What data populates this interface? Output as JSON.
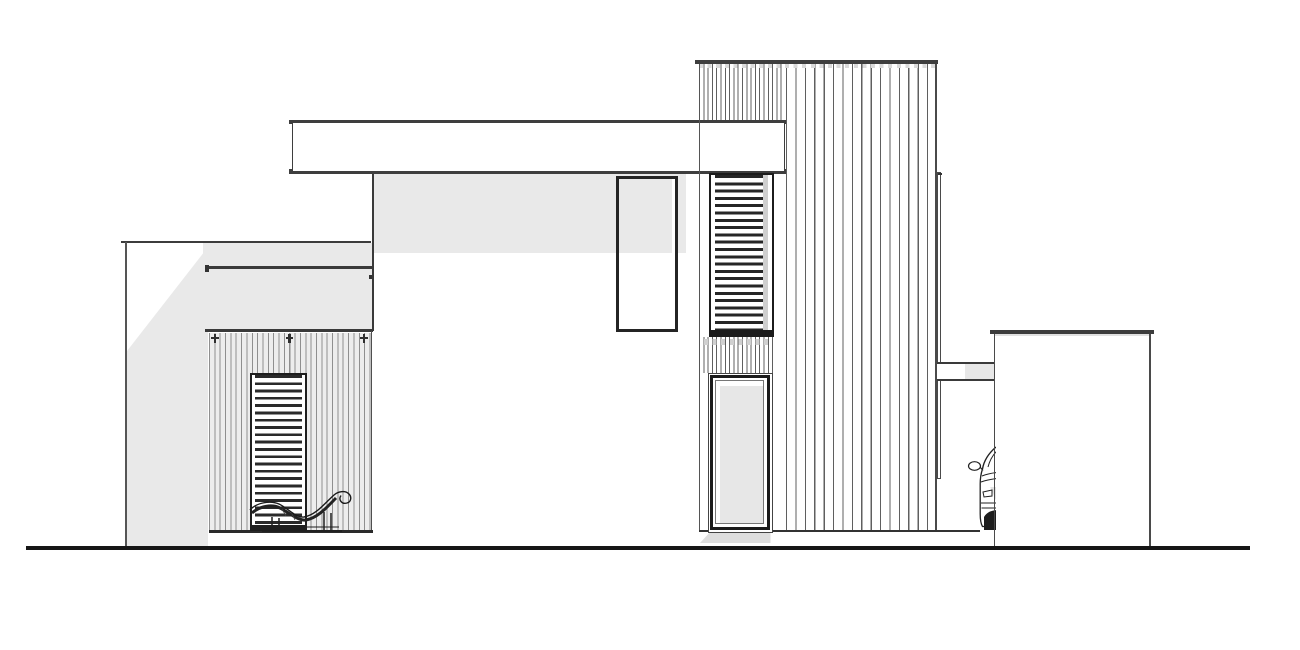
{
  "drawing": {
    "kind": "architectural-side-elevation",
    "canvas": {
      "w": 1300,
      "h": 650,
      "background": "#ffffff"
    },
    "palette": {
      "paper": "#ffffff",
      "line_dark": "#1c1c1c",
      "line_mid": "#3e3e3e",
      "line_light": "#8f8f8f",
      "shadow_fill": "#e9e9e9",
      "ground": "#161616"
    }
  },
  "scene": [
    {
      "name": "left-wall-shadow",
      "x": 126.5,
      "y": 247,
      "w": 81.5,
      "h": 299,
      "style": {
        "background": "#e9e9e9",
        "clipPath": "polygon(100% 0, 100% 100%, 0 100%, 0 35%)"
      }
    },
    {
      "name": "porch-header-shade",
      "x": 203,
      "y": 242.5,
      "w": 170,
      "h": 88.5,
      "style": {
        "background": "#e9e9e9"
      }
    },
    {
      "name": "facade-shadow-band",
      "x": 373.5,
      "y": 173.5,
      "w": 312.5,
      "h": 79.5,
      "style": {
        "background": "#e9e9e9"
      }
    },
    {
      "name": "left-wall-top-edge",
      "x": 121,
      "y": 240.5,
      "w": 250,
      "h": 2.2,
      "style": {
        "background": "#3c3c3c"
      }
    },
    {
      "name": "left-wall-corner-edge",
      "x": 125,
      "y": 242,
      "w": 1.5,
      "h": 304,
      "style": {
        "background": "#555555"
      }
    },
    {
      "name": "porch-fascia-top-edge",
      "x": 204.5,
      "y": 266,
      "w": 168,
      "h": 3,
      "style": {
        "background": "#3a3a3a"
      }
    },
    {
      "name": "fascia-left-bracket",
      "x": 205,
      "y": 265,
      "w": 4,
      "h": 7,
      "style": {
        "background": "#333333"
      }
    },
    {
      "name": "fascia-right-bracket",
      "x": 368.5,
      "y": 274.5,
      "w": 4,
      "h": 4,
      "style": {
        "background": "#333333"
      }
    },
    {
      "name": "porch-fascia-bottom-edge",
      "x": 204.5,
      "y": 329,
      "w": 168,
      "h": 2.5,
      "style": {
        "background": "#3a3a3a"
      }
    },
    {
      "name": "house-left-corner-edge",
      "x": 372,
      "y": 173,
      "w": 1.6,
      "h": 158,
      "style": {
        "background": "#3a3a3a"
      }
    },
    {
      "name": "porch-siding",
      "x": 208.5,
      "y": 333,
      "w": 162,
      "h": 197.5,
      "style": {
        "background": "repeating-linear-gradient(90deg, #8f8f8f 0 1px, rgba(0,0,0,0) 1px 5.35px) #ededed"
      }
    },
    {
      "name": "porch-siding-right-edge",
      "x": 370.6,
      "y": 331,
      "w": 1.4,
      "h": 201.5,
      "style": {
        "background": "#4f4f4f"
      }
    },
    {
      "name": "porch-clip-1",
      "x": 213.5,
      "y": 334,
      "w": 2.6,
      "h": 9,
      "style": {
        "background": "#2f2f2f"
      }
    },
    {
      "name": "porch-clip-1-bar",
      "x": 211,
      "y": 336.5,
      "w": 7.5,
      "h": 2,
      "style": {
        "background": "#2f2f2f"
      }
    },
    {
      "name": "porch-clip-2",
      "x": 288,
      "y": 334,
      "w": 2.6,
      "h": 9,
      "style": {
        "background": "#2f2f2f"
      }
    },
    {
      "name": "porch-clip-2-bar",
      "x": 285.5,
      "y": 336.5,
      "w": 7.5,
      "h": 2,
      "style": {
        "background": "#2f2f2f"
      }
    },
    {
      "name": "porch-clip-3",
      "x": 362.5,
      "y": 334,
      "w": 2.6,
      "h": 9,
      "style": {
        "background": "#2f2f2f"
      }
    },
    {
      "name": "porch-clip-3-bar",
      "x": 360,
      "y": 336.5,
      "w": 7.5,
      "h": 2,
      "style": {
        "background": "#2f2f2f"
      }
    },
    {
      "name": "porch-floor-edge",
      "x": 208.5,
      "y": 530,
      "w": 164,
      "h": 2.6,
      "style": {
        "background": "#2a2a2a"
      }
    },
    {
      "name": "porch-louver-door",
      "x": 250,
      "y": 372.5,
      "w": 57,
      "h": 158.5,
      "style": {
        "border": "2.5px solid #1e1e1e",
        "background": "repeating-linear-gradient(180deg, #2a2a2a 0 2.8px, #ffffff 2.8px 7.3px)",
        "boxShadow": "inset 0 -4px 0 #1e1e1e, inset 3px 0 0 #ffffff, inset -3px 0 0 #ffffff"
      }
    },
    {
      "name": "chaise-lounge",
      "x": 246,
      "y": 487,
      "w": 112,
      "h": 46,
      "svg": {
        "w": 112,
        "h": 46,
        "viewBox": "0 0 112 46",
        "els": [
          {
            "tag": "path",
            "attrs": {
              "d": "M16 44 H96",
              "stroke": "#1f1f1f",
              "stroke-width": "1.8",
              "fill": "none"
            }
          },
          {
            "tag": "path",
            "attrs": {
              "d": "M19 40 H93",
              "stroke": "#1f1f1f",
              "stroke-width": "1",
              "fill": "none"
            }
          },
          {
            "tag": "path",
            "attrs": {
              "d": "M26 44 V30 M33 44 V31 M78 44 V25 M85 44 V26",
              "stroke": "#1f1f1f",
              "stroke-width": "1.5",
              "fill": "none"
            }
          },
          {
            "tag": "path",
            "attrs": {
              "d": "M6 26 C14 19 26 17 34 21 C44 26 52 34 60 33 C72 31 82 19 90 11",
              "stroke": "#222222",
              "stroke-width": "3",
              "fill": "none"
            }
          },
          {
            "tag": "path",
            "attrs": {
              "d": "M4 23 C10 16 24 13 33 17 C43 22 50 31 58 30 C70 28 78 17 88 8 C92 4.5 99 3 103 7 C106 10 105 15 101 16 C96 17.5 92 13 95 8.5",
              "stroke": "#1a1a1a",
              "stroke-width": "1.4",
              "fill": "none"
            }
          },
          {
            "tag": "path",
            "attrs": {
              "d": "M36 22 l4 7 M46 27 l3 6",
              "stroke": "#444444",
              "stroke-width": "0.8",
              "fill": "none"
            }
          }
        ]
      }
    },
    {
      "name": "main-roof-band",
      "x": 292,
      "y": 119.5,
      "w": 492.5,
      "h": 54.2,
      "style": {
        "background": "#ffffff",
        "borderTop": "3.6px solid #3e3e3e",
        "borderBottom": "3.6px solid #3e3e3e",
        "borderLeft": "1.6px solid #3e3e3e",
        "borderRight": "1.6px solid #3e3e3e"
      }
    },
    {
      "name": "roof-nub-top-left",
      "x": 289.3,
      "y": 119.5,
      "w": 3.2,
      "h": 4.5,
      "style": {
        "background": "#3e3e3e"
      }
    },
    {
      "name": "roof-nub-top-right",
      "x": 784.3,
      "y": 119.5,
      "w": 3.2,
      "h": 4.5,
      "style": {
        "background": "#3e3e3e"
      }
    },
    {
      "name": "roof-nub-bottom-left",
      "x": 289.3,
      "y": 169.2,
      "w": 3.2,
      "h": 4.5,
      "style": {
        "background": "#3e3e3e"
      }
    },
    {
      "name": "roof-nub-bottom-right",
      "x": 784.3,
      "y": 169.2,
      "w": 3.2,
      "h": 4.5,
      "style": {
        "background": "#3e3e3e"
      }
    },
    {
      "name": "mid-box-window",
      "x": 616,
      "y": 175.5,
      "w": 61.8,
      "h": 156.8,
      "style": {
        "border": "3.5px solid #242424",
        "background": "linear-gradient(#e9e9e9 0 74px, #ffffff 74px)",
        "boxShadow": "inset -3px 0 0 #ffffff"
      }
    },
    {
      "name": "tower-main-siding",
      "x": 785.5,
      "y": 63.5,
      "w": 150,
      "h": 467.5,
      "style": {
        "background": "repeating-linear-gradient(90deg, #5f5f5f 0 1.2px, rgba(0,0,0,0) 1.2px 9.4px) #ffffff"
      }
    },
    {
      "name": "tower-upper-dense-siding",
      "x": 699,
      "y": 63.5,
      "w": 85.5,
      "h": 56,
      "style": {
        "background": "repeating-linear-gradient(90deg, #5f5f5f 0 1px, rgba(0,0,0,0) 1px 4.3px) #ffffff"
      }
    },
    {
      "name": "tower-mid-dense-siding",
      "x": 699,
      "y": 336.5,
      "w": 76,
      "h": 36,
      "style": {
        "background": "repeating-linear-gradient(90deg, #5f5f5f 0 1px, rgba(0,0,0,0) 1px 4.3px) #ffffff"
      }
    },
    {
      "name": "tower-clip-dashes",
      "x": 704,
      "y": 339,
      "w": 68,
      "h": 6,
      "style": {
        "background": "repeating-linear-gradient(90deg, #d0d0d0 0 4px, rgba(0,0,0,0) 4px 8.6px)"
      }
    },
    {
      "name": "tower-parapet-cap",
      "x": 694.5,
      "y": 60,
      "w": 243.5,
      "h": 3.6,
      "style": {
        "background": "#3e3e3e"
      }
    },
    {
      "name": "tower-cap-dashes",
      "x": 699,
      "y": 64,
      "w": 237,
      "h": 4,
      "style": {
        "background": "repeating-linear-gradient(90deg, #dadada 0 4px, rgba(0,0,0,0) 4px 8.6px)"
      }
    },
    {
      "name": "tower-left-corner-edge",
      "x": 698.5,
      "y": 63.5,
      "w": 1.4,
      "h": 467.5,
      "style": {
        "background": "#555555"
      }
    },
    {
      "name": "tower-right-corner-edge",
      "x": 935.2,
      "y": 63.5,
      "w": 1.7,
      "h": 467.5,
      "style": {
        "background": "#4a4a4a"
      }
    },
    {
      "name": "tower-louver-window",
      "x": 709,
      "y": 172.5,
      "w": 65,
      "h": 164,
      "style": {
        "border": "2.5px solid #1c1c1c",
        "background": "repeating-linear-gradient(180deg, #262626 0 3px, #ffffff 3px 7.3px)",
        "boxShadow": "inset 0 -5px 0 #1c1c1c, inset 4px 0 0 #ffffff, inset -4px 0 0 #ffffff, inset -9px 0 0 #cfcfcf"
      }
    },
    {
      "name": "carport-floor-edge",
      "x": 699,
      "y": 529.6,
      "w": 281,
      "h": 2,
      "style": {
        "background": "#333333"
      }
    },
    {
      "name": "tall-window-ground-shadow",
      "x": 700,
      "y": 533,
      "w": 70.5,
      "h": 10,
      "style": {
        "background": "#dedede",
        "clipPath": "polygon(13% 0, 100% 0, 100% 100%, 0 100%)"
      }
    },
    {
      "name": "tower-tall-window",
      "x": 707.5,
      "y": 372.5,
      "w": 65.5,
      "h": 160.5,
      "style": {
        "background": "#ffffff",
        "border": "1.2px solid #444444"
      },
      "children": [
        {
          "name": "tall-window-frame",
          "x": 1.8,
          "y": 1.8,
          "w": 59.5,
          "h": 154.5,
          "style": {
            "background": "#ffffff",
            "border": "3.6px solid #1b1b1b"
          },
          "children": [
            {
              "name": "tall-window-glass",
              "x": 1.6,
              "y": 1.6,
              "w": 49.1,
              "h": 144.1,
              "style": {
                "background": "#ffffff",
                "border": "0.8px solid #777777"
              },
              "children": [
                {
                  "name": "tall-window-glass-shade",
                  "x": 4.5,
                  "y": 4.8,
                  "w": 43,
                  "h": 137.7,
                  "style": {
                    "background": "#e7e7e7"
                  }
                }
              ]
            }
          ]
        }
      ]
    },
    {
      "name": "tower-side-fin",
      "x": 936.9,
      "y": 172,
      "w": 4.3,
      "h": 307,
      "style": {
        "background": "#ffffff",
        "border": "1px solid #4a4a4a"
      },
      "children": [
        {
          "name": "fin-top-tick",
          "x": 0,
          "y": 0,
          "w": 4.3,
          "h": 2,
          "style": {
            "background": "#333333"
          }
        },
        {
          "name": "fin-mid-tick",
          "x": 0,
          "y": 190,
          "w": 4.3,
          "h": 2,
          "style": {
            "background": "#444444"
          }
        }
      ]
    },
    {
      "name": "carport-link-beam",
      "x": 937,
      "y": 362,
      "w": 57.5,
      "h": 18.6,
      "style": {
        "borderTop": "2.2px solid #3a3a3a",
        "borderBottom": "2.2px solid #3a3a3a",
        "background": "linear-gradient(90deg, #ffffff 0 48%, #e7e7e7 48%)"
      }
    },
    {
      "name": "car-behind-garage",
      "x": 966.5,
      "y": 446,
      "w": 29.3,
      "h": 85,
      "style": {
        "overflow": "hidden"
      },
      "svg": {
        "w": 40,
        "h": 85,
        "viewBox": "0 0 40 85",
        "els": [
          {
            "tag": "rect",
            "attrs": {
              "x": "21",
              "y": "41",
              "width": "12",
              "height": "43",
              "fill": "#e3e3e3"
            }
          },
          {
            "tag": "path",
            "attrs": {
              "d": "M29 1 C22 7 17 14 15.5 23",
              "stroke": "#222222",
              "stroke-width": "1.4",
              "fill": "none"
            }
          },
          {
            "tag": "path",
            "attrs": {
              "d": "M33 2 C27 7 23 13 21 21",
              "stroke": "#222222",
              "stroke-width": "1",
              "fill": "none"
            }
          },
          {
            "tag": "ellipse",
            "attrs": {
              "cx": "7.5",
              "cy": "20",
              "rx": "6",
              "ry": "4.3",
              "fill": "#ffffff",
              "stroke": "#222222",
              "stroke-width": "1.2"
            }
          },
          {
            "tag": "path",
            "attrs": {
              "d": "M13 21 L16 24.5",
              "stroke": "#222222",
              "stroke-width": "1.2",
              "fill": "none"
            }
          },
          {
            "tag": "path",
            "attrs": {
              "d": "M15.5 23 C13.8 28 13.2 33 13.2 38 L13.2 68 C13.2 74 14 78 15.5 80.5 L40 80.5",
              "stroke": "#222222",
              "stroke-width": "1.3",
              "fill": "#ffffff"
            }
          },
          {
            "tag": "path",
            "attrs": {
              "d": "M15 30 C22 27 31 26 40 26",
              "stroke": "#222222",
              "stroke-width": "1",
              "fill": "none"
            }
          },
          {
            "tag": "path",
            "attrs": {
              "d": "M14 36 C22 33 32 32 40 32",
              "stroke": "#222222",
              "stroke-width": "1",
              "fill": "none"
            }
          },
          {
            "tag": "path",
            "attrs": {
              "d": "M16 46 L25 44 L25 50 L17 51 Z",
              "stroke": "#222222",
              "stroke-width": "1",
              "fill": "#ffffff"
            }
          },
          {
            "tag": "path",
            "attrs": {
              "d": "M14 57 H40 M14.5 62 H40",
              "stroke": "#222222",
              "stroke-width": "1",
              "fill": "none"
            }
          },
          {
            "tag": "path",
            "attrs": {
              "d": "M17 84 L17 71 C20 65.5 26 64 31 64 L31 84 Z",
              "fill": "#1d1d1d"
            }
          }
        ]
      }
    },
    {
      "name": "garage-roof-edge",
      "x": 990,
      "y": 330,
      "w": 163.5,
      "h": 4.2,
      "style": {
        "background": "#3c3c3c"
      }
    },
    {
      "name": "garage-roof-underline",
      "x": 993.5,
      "y": 334.2,
      "w": 156.5,
      "h": 1.8,
      "style": {
        "background": "#e0e0e0"
      }
    },
    {
      "name": "garage-left-corner-edge",
      "x": 993.6,
      "y": 334,
      "w": 1.7,
      "h": 212,
      "style": {
        "background": "#4a4a4a"
      }
    },
    {
      "name": "garage-right-corner-edge",
      "x": 1148.9,
      "y": 334,
      "w": 1.7,
      "h": 212,
      "style": {
        "background": "#4a4a4a"
      }
    },
    {
      "name": "ground-line",
      "x": 26,
      "y": 546,
      "w": 1224,
      "h": 3.6,
      "style": {
        "background": "#161616"
      }
    }
  ]
}
